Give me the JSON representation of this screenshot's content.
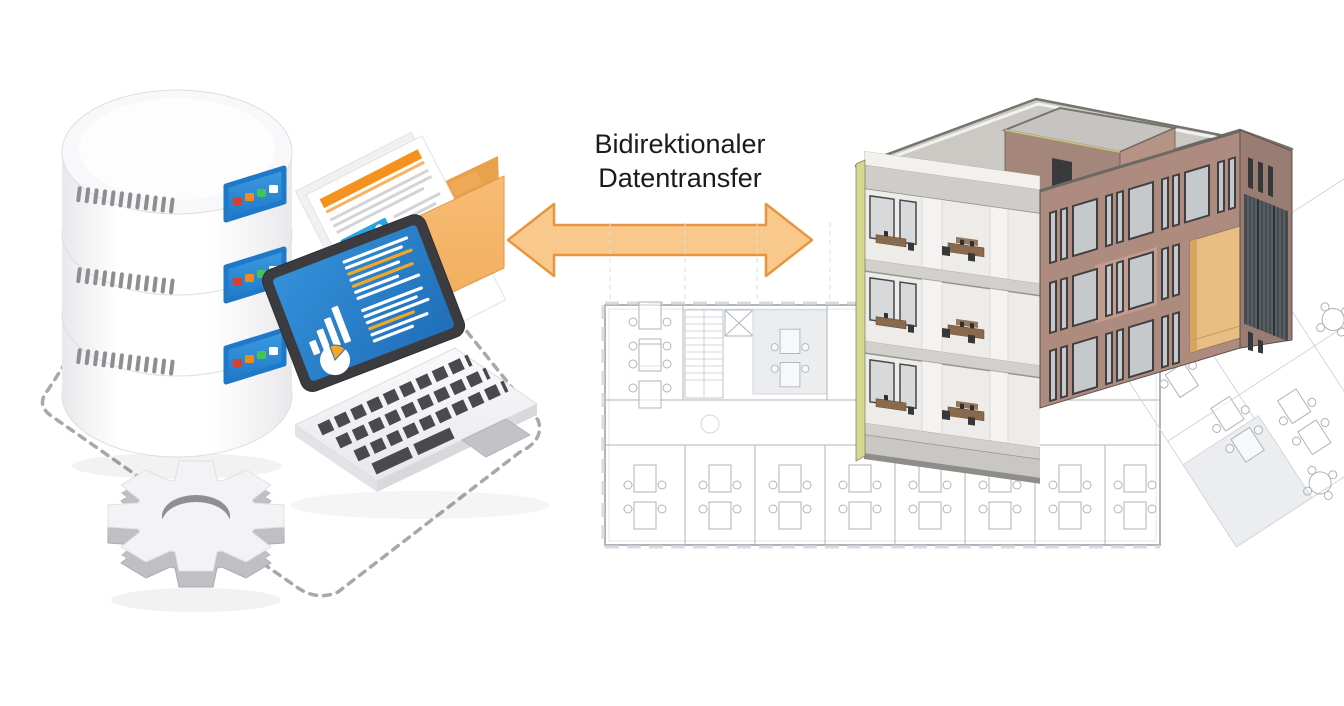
{
  "title": {
    "line1": "Bidirektionaler",
    "line2": "Datentransfer"
  },
  "scene": {
    "left_group": {
      "name": "database-system-illustration",
      "parts": [
        "database-stack",
        "documents-folder",
        "analytics-laptop",
        "gear",
        "dashed-connection-path"
      ],
      "database_layers": 3,
      "database_indicator_colors": [
        "red",
        "orange",
        "green",
        "white"
      ]
    },
    "center": {
      "arrow": "bidirectional"
    },
    "right_group": {
      "name": "bim-building-model",
      "parts": [
        "3d-building-cutaway",
        "roof-penthouse",
        "glass-curtain-wall",
        "entrance-niche",
        "floor-plan"
      ],
      "cutaway_floor_count": 3
    }
  },
  "colors": {
    "ink": "#1B1B1B",
    "dash": "#A8A8AC",
    "arrowFill": "#F9C98C",
    "arrowStroke": "#E8953F",
    "dbBody": "#FFFFFF",
    "dbShade": "#E9E9EC",
    "dbTop": "#F8F8FA",
    "dbSeam": "#DEDEE2",
    "vent": "#8E8E92",
    "panel1": "#3D9BE0",
    "panel2": "#1E79C8",
    "lightRed": "#D7402F",
    "lightOrange": "#EE8C1F",
    "lightGreen": "#44C25C",
    "lightWhite": "#FFFFFF",
    "folderFront1": "#F7BC74",
    "folderFront2": "#F0A957",
    "folderBack": "#E8A14D",
    "folderSide": "#D98F3F",
    "paper": "#FFFFFF",
    "paperEdge": "#E3E3E6",
    "docHeader": "#F5921E",
    "docLine": "#D4D4D8",
    "imgBg": "#29A3E1",
    "imgAccent": "#F5921E",
    "deck1": "#FAFAFC",
    "deck2": "#E8E8EC",
    "deckEdge": "#DDDDE1",
    "key": "#4A4A4E",
    "bezel": "#3C3C40",
    "screen1": "#3490D9",
    "screen2": "#1F6FB8",
    "chartW": "#FFFFFF",
    "chartO": "#F5A623",
    "trackpad": "#C3C3C7",
    "gearTop": "#F3F3F5",
    "gearSide": "#BFBFC4",
    "gearHole": "#8E8F95",
    "planLine": "#AFB4BA",
    "planLight": "#D3D7DC",
    "planFill": "#ECEDEF",
    "facade": "#AE8B7F",
    "facadeDark": "#9A7D72",
    "facadeLight": "#C19C8F",
    "roof": "#CBC9C4",
    "roofEdge": "#76746F",
    "parapet": "#F2F1EE",
    "penthouseL": "#A4867A",
    "penthouseR": "#B59486",
    "penthouseTop": "#C6C4C0",
    "cutYellow": "#D8D890",
    "interior": "#EDECE9",
    "slab": "#D2D0CC",
    "slabEdge": "#97948F",
    "column": "#F4F3F1",
    "winGlass": "#C6C9CB",
    "winFrame": "#3F3F41",
    "glassDark": "#454B4F",
    "glassLine": "#8A9094",
    "niche": "#E9BE83",
    "nicheShade": "#D8A462",
    "desk": "#8A6A4C",
    "chair": "#38383A",
    "base": "#C9C7C3"
  }
}
